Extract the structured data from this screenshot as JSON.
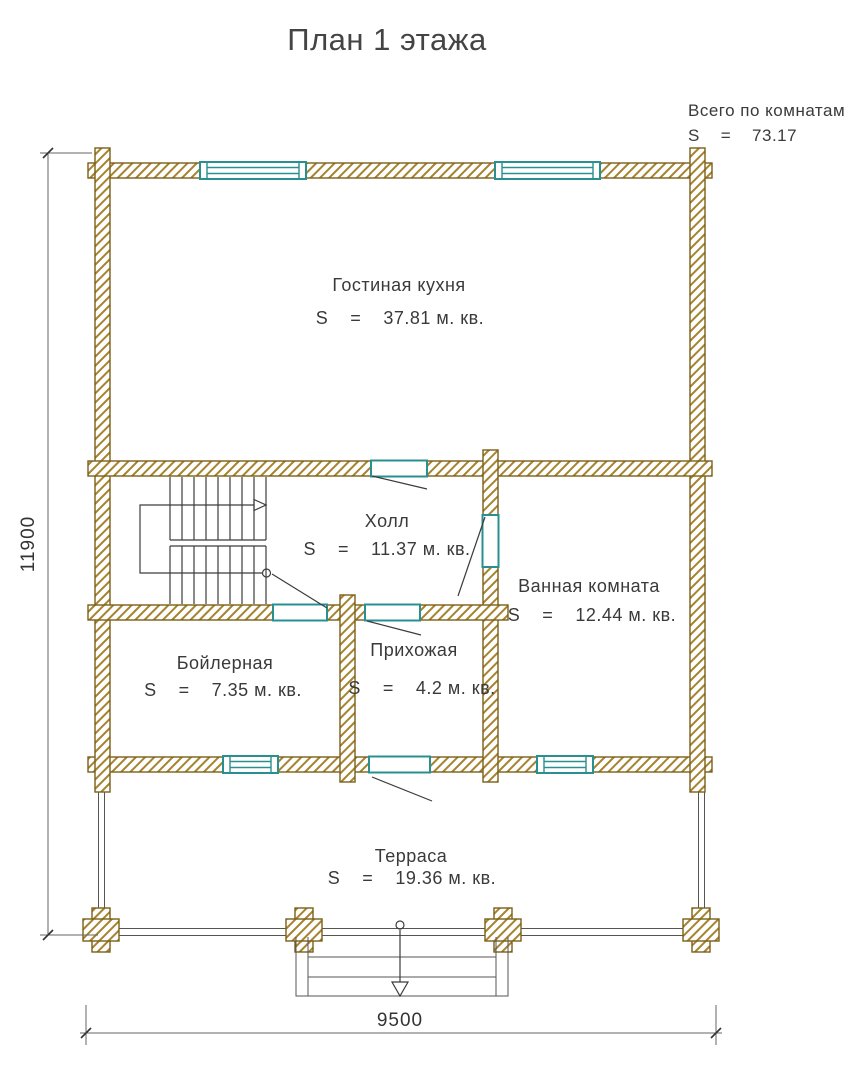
{
  "title": "План 1 этажа",
  "summary": {
    "label": "Всего по комнатам",
    "area": "S    =    73.17"
  },
  "rooms": [
    {
      "id": "living-kitchen",
      "name": "Гостиная кухня",
      "area": "S    =    37.81 м. кв."
    },
    {
      "id": "hall",
      "name": "Холл",
      "area": "S    =    11.37 м. кв."
    },
    {
      "id": "bathroom",
      "name": "Ванная комната",
      "area": "S    =    12.44 м. кв."
    },
    {
      "id": "boiler-room",
      "name": "Бойлерная",
      "area": "S    =    7.35 м. кв."
    },
    {
      "id": "entry-hall",
      "name": "Прихожая",
      "area": "S    =    4.2 м. кв."
    },
    {
      "id": "terrace",
      "name": "Терраса",
      "area": "S    =    19.36 м. кв."
    }
  ],
  "dimensions": {
    "height_mm": "11900",
    "width_mm": "9500"
  },
  "colors": {
    "wall_hatch": "#a5832f",
    "wall_outline": "#7a5f17",
    "opening_teal": "#2a8f8f",
    "line": "#3c3c3c"
  }
}
